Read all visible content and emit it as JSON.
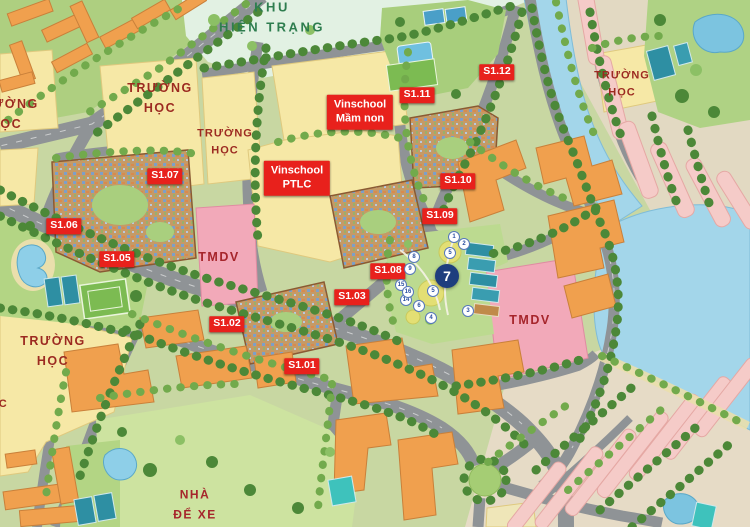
{
  "map": {
    "zone_labels": {
      "khu_hien_trang": "KHU\nHIỆN TRẠNG",
      "truong_hoc": "TRƯỜNG\nHỌC",
      "truong_hoc_partial": "HỌC",
      "nha_de_xe": "NHÀ\nĐỂ XE",
      "tmdv": "TMDV"
    },
    "school_labels": {
      "vinschool_mamnon": "Vinschool\nMầm non",
      "vinschool_ptlc": "Vinschool\nPTLC"
    },
    "building_markers": [
      {
        "label": "S1.01"
      },
      {
        "label": "S1.02"
      },
      {
        "label": "S1.03"
      },
      {
        "label": "S1.05"
      },
      {
        "label": "S1.06"
      },
      {
        "label": "S1.07"
      },
      {
        "label": "S1.08"
      },
      {
        "label": "S1.09"
      },
      {
        "label": "S1.10"
      },
      {
        "label": "S1.11"
      },
      {
        "label": "S1.12"
      }
    ],
    "poi_badge": "7",
    "poi_markers": [
      {
        "n": "1"
      },
      {
        "n": "2"
      },
      {
        "n": "3"
      },
      {
        "n": "4"
      },
      {
        "n": "5"
      },
      {
        "n": "5"
      },
      {
        "n": "6"
      },
      {
        "n": "8"
      },
      {
        "n": "9"
      },
      {
        "n": "14"
      },
      {
        "n": "15"
      },
      {
        "n": "16"
      }
    ],
    "colors": {
      "marker_red": "#E8211C",
      "marker_text": "#FFFFFF",
      "school_text": "#9C2A21",
      "zone_text": "#2E7D4F",
      "tmdv_text": "#A6252B",
      "badge_navy": "#1E3E7E",
      "water": "#A3D6EA",
      "road": "#8F9396",
      "school_block": "#F6E8A6",
      "tmdv_block": "#F2A9B9",
      "shophouse_pink": "#F5CBC8",
      "building_orange": "#F0A04E",
      "park_green": "#B9D98C",
      "existing_zone_mint": "#E2F1E3",
      "tree_dark": "#4C8838",
      "tree_light": "#72AA4C",
      "court_teal": "#2E8FA3"
    }
  }
}
